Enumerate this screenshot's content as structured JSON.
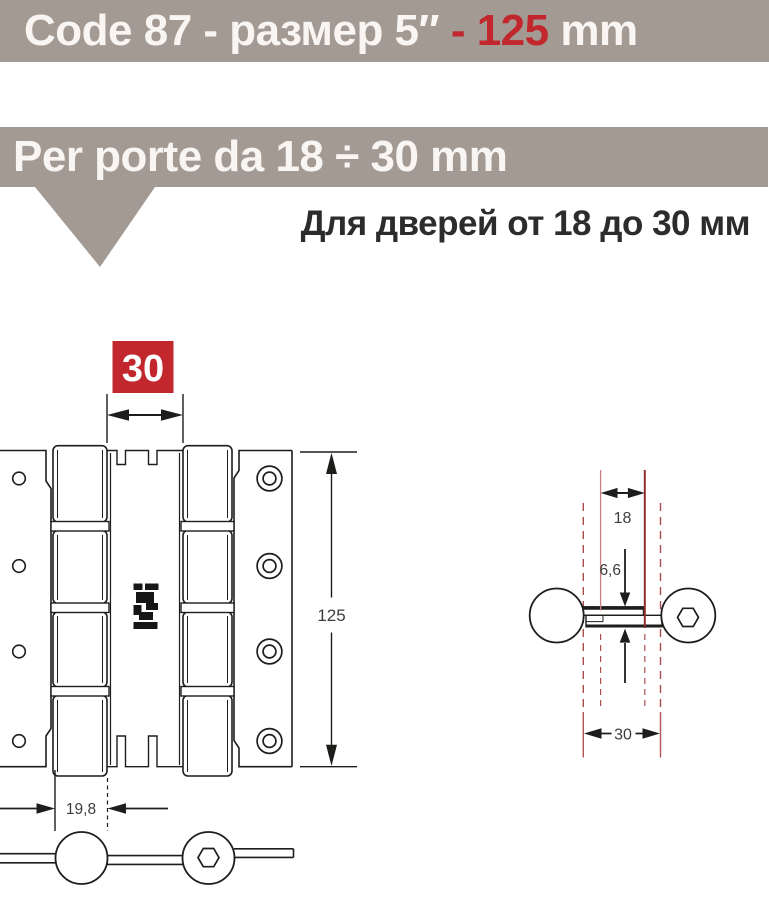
{
  "header": {
    "title_white_1": "Code 87 - размер 5″",
    "title_red": " - 125",
    "title_white_2": " mm"
  },
  "bar2": {
    "label": "Per porte da 18 ÷ 30 mm"
  },
  "note_ru": "Для дверей от 18 до 30 мм",
  "dims": {
    "gap": "30",
    "height": "125",
    "knuckle": "19,8",
    "door_min": "18",
    "plate": "6,6",
    "door_max": "30"
  },
  "colors": {
    "bar_bg": "#a39a93",
    "accent_red": "#c1272d",
    "line_black": "#1d1d1b",
    "dim_text": "#3d3d3d",
    "door_solid_dark": "#8c2e2e",
    "door_solid_light": "#c98080",
    "door_dashed": "#aa4f4f"
  }
}
